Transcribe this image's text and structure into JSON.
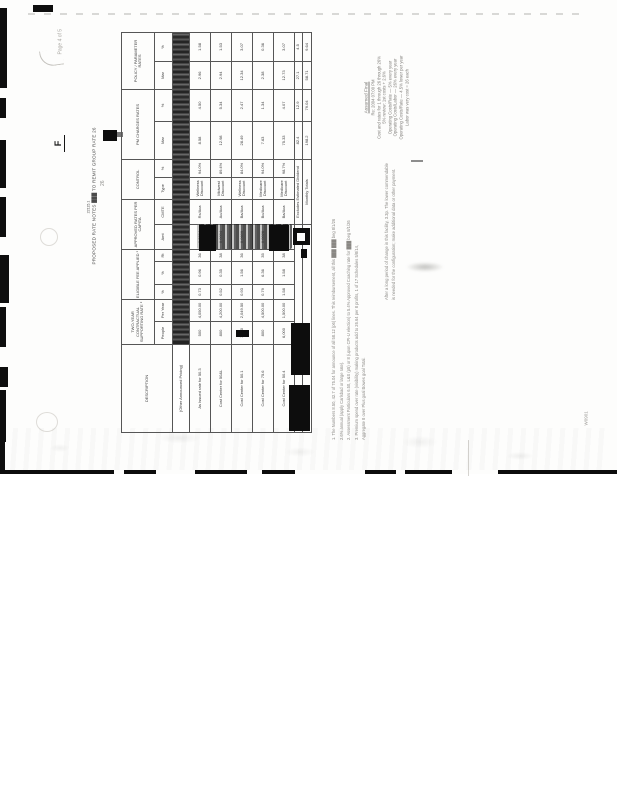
{
  "page": {
    "number_label": "Page 4 of 5",
    "bates": "W0901",
    "f_mark": "F",
    "side_mark": "26"
  },
  "title": {
    "code": "22115.1",
    "text": "PROPOSED RATE NOTES ███ TO REMIT GROUP RATE 26"
  },
  "table": {
    "groups": [
      "DESCRIPTION",
      "TWO-YEAR CONTRACTUAL SUPPORTING RATE ²",
      "ELIGIBLE FEE APPLIED ¹",
      "APPROVED RATES PER CAPITA",
      "CONTROL",
      "PM CHARGES RATES",
      "POLICY / PARAMETER RATES"
    ],
    "subheaders": [
      "People",
      "Per Year",
      "%",
      "%",
      "Rt",
      "Amt",
      "CMTE",
      "Type",
      "%",
      "Mar",
      "%",
      "Mar",
      "%"
    ],
    "stripe_row_label": "(Other Announced Pricing)",
    "rows": [
      {
        "desc": "As Issued rate for 50.3",
        "values": [
          "500",
          "4,050.00",
          "0.73",
          "0.96",
          "36",
          "0.0964",
          "Rx/Aca",
          "Wellness Discount",
          "94.0%",
          "8.58",
          "4.50",
          "2.96",
          "1.58"
        ]
      },
      {
        "desc": "Cost Center for 50&L",
        "values": [
          "800",
          "4,200.00",
          "0.52",
          "0.35",
          "38",
          "0.0004",
          "Ao/Aca",
          "Midwest Discount",
          "89.4%",
          "12.98",
          "5.34",
          "2.94",
          "1.53"
        ]
      },
      {
        "desc": "Cost Center for 50.1",
        "values": [
          "1,600",
          "2,049.50",
          "0.93",
          "1.56",
          "36",
          "0.0609",
          "Ba/Aca",
          "Wellness Discount",
          "84.0%",
          "28.49",
          "2.47",
          "12.34",
          "3.07"
        ]
      },
      {
        "desc": "Cost Center for 75.6",
        "values": [
          "800",
          "4,500.00",
          "0.79",
          "6.36",
          "35",
          "0.0026",
          "Bo/Aca",
          "Medicare Discount",
          "94.0%",
          "7.63",
          "1.34",
          "2.38",
          "0.36"
        ]
      },
      {
        "desc": "Cost Center for 50.4",
        "values": [
          "6,000",
          "1,500.00",
          "1.58",
          "1.58",
          "38",
          "0.0040",
          "Ba/Aca",
          "Medicare Discount",
          "98.7%",
          "75.33",
          "4.07",
          "12.73",
          "3.07"
        ]
      }
    ],
    "totals": [
      {
        "label": "Excludes Estimated Dividend",
        "values": [
          "82.4",
          "12.9",
          "27.1",
          "4.5"
        ]
      },
      {
        "label": "Monthly Totals",
        "values": [
          "198.2",
          "79.04",
          "58.71",
          "9.64"
        ]
      }
    ]
  },
  "notes_right": {
    "heading": "Assumed Final",
    "lines": [
      "Re: 2004 07:00 PM",
      "Cost and rates for 1 through 26 through 26%",
      "5% review: 1st costs + 2.6%",
      "Operating Costs/Rate — 5% every year",
      "Operating Costs/Labor — 26% every year",
      "Operating Costs/Rate — 4.5% lower per year",
      "Labor was very cost = 26 each"
    ]
  },
  "footnotes": {
    "lines": [
      "1. The Numbers 8.50, 42.7 of 75.04 for announce of all 58.12 (p6) lines. This reimbursement, all this ███ ███ beg 8/1/26",
      "2.6% annual (apply Carlsbad or large rate).",
      "2. Assessment Particulars 6.50, L&S (p5) or 8 (upon CPI-U election) to 5.4% Approved Coaching rate for ███ beg 8/1/26",
      "3. Premium spend over rate (visibility) making products add to 26.64 per 8 profits, 1 of 17 Schedules 5/8/14,",
      "Aggregate 8 over Plus goal Bowes goal Total."
    ]
  },
  "note_lower": {
    "lines": [
      "After a long period of change in this facility, 3.3p. The lower commendable",
      "is needed for the configuration; make additional data or other payment."
    ]
  },
  "colors": {
    "ink": "#3a3a3a",
    "faded_ink": "#8a8884",
    "border": "#565656",
    "stripe": "#2b2b2b",
    "redaction": "#0d0d0d"
  }
}
